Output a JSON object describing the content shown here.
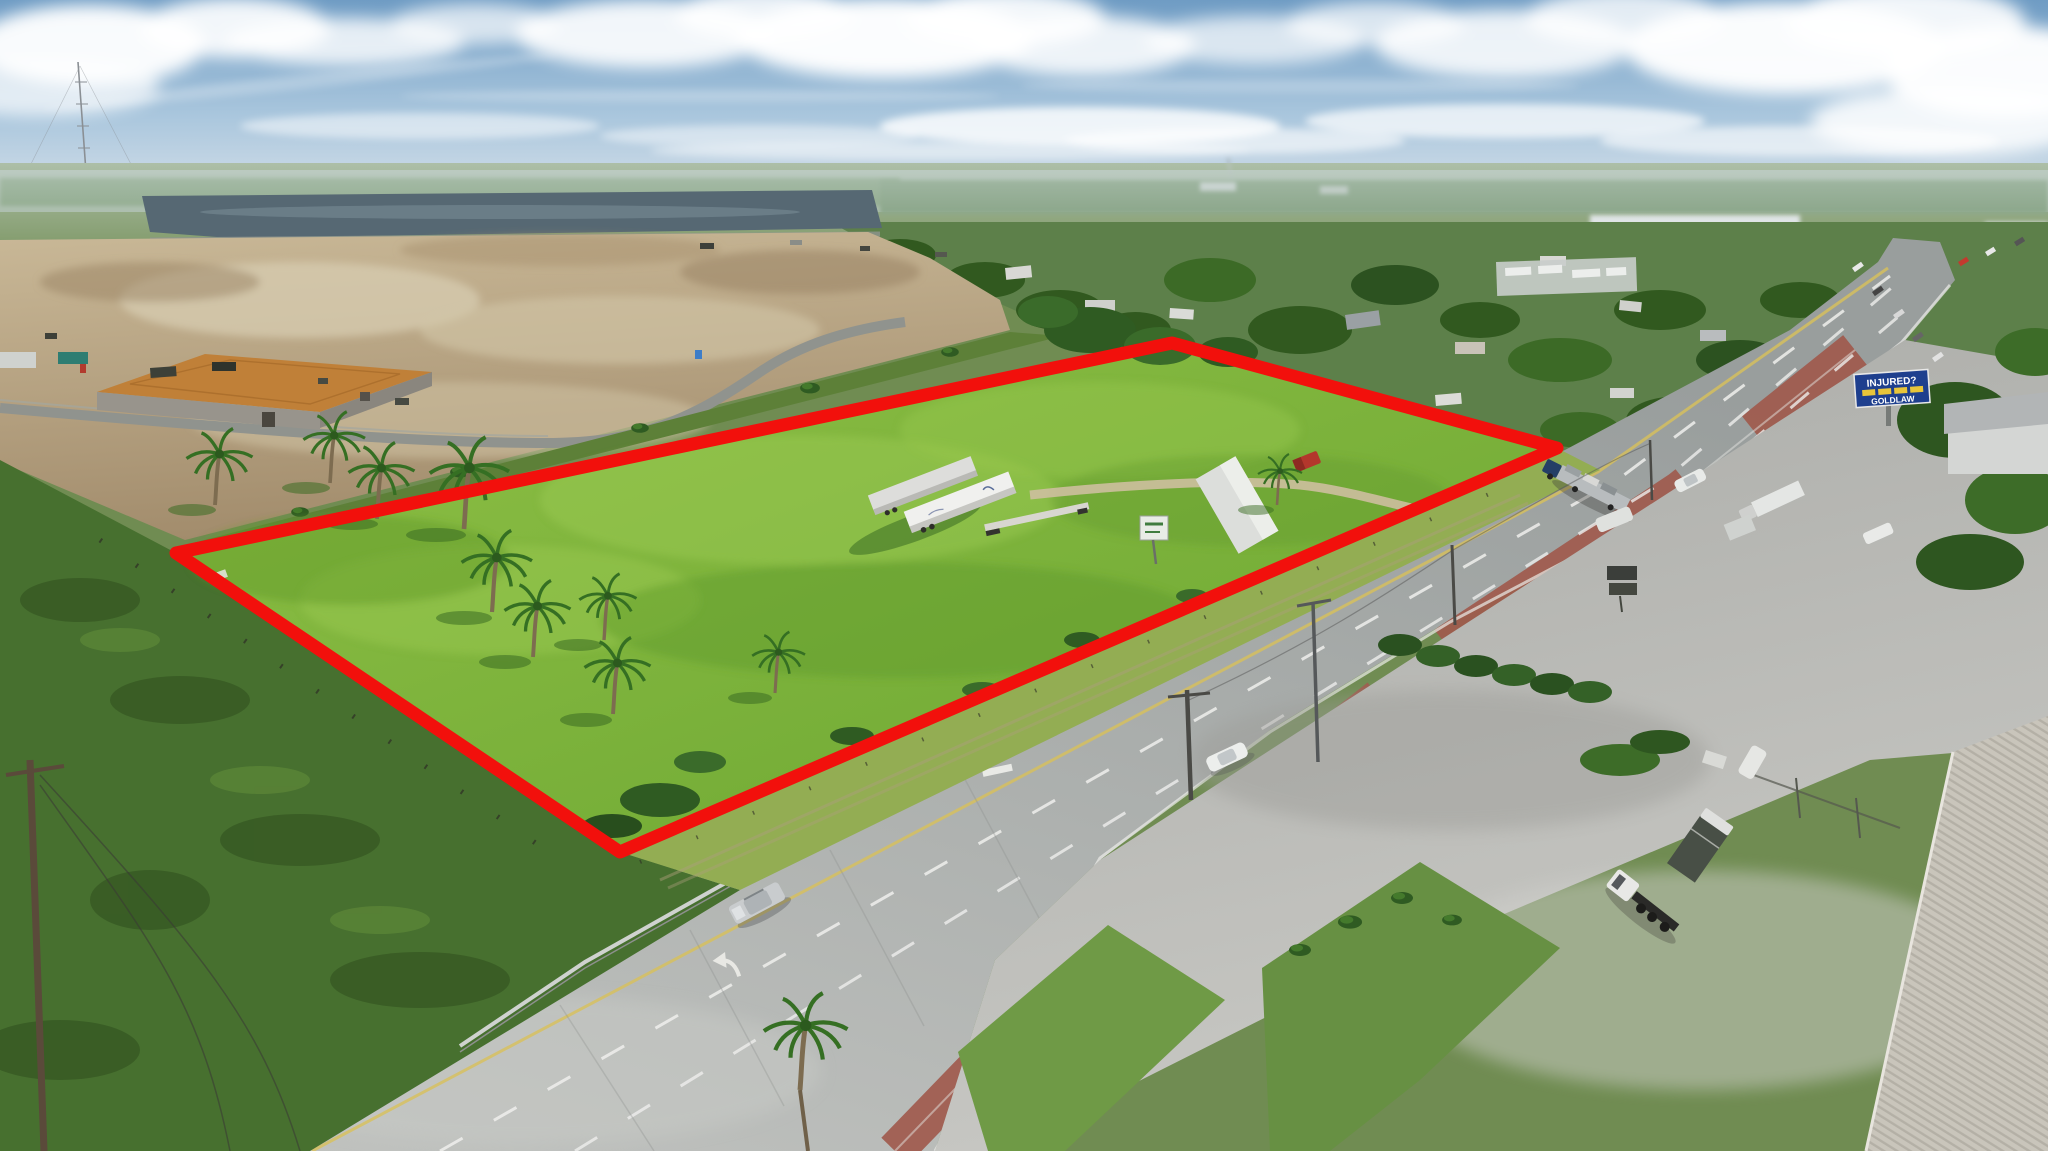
{
  "meta": {
    "type": "aerial-drone-photograph",
    "subject": "Vacant commercial land parcel outlined in red along a divided highway"
  },
  "palette": {
    "outline_red": "#f2100c",
    "sky_blue": "#7fa6c9",
    "parcel_green": "#7db43c",
    "dirt_tan": "#b7a489",
    "road_gray": "#b2b5b3",
    "median_brick": "#a05a4d",
    "pond_water": "#566873",
    "billboard_blue": "#1e3f8e",
    "billboard_text": "#ffffff"
  },
  "overlay": {
    "parcel_outline": {
      "color": "#f2100c",
      "stroke_width_px": 13,
      "vertices_px": [
        [
          176,
          553
        ],
        [
          1172,
          343
        ],
        [
          1557,
          448
        ],
        [
          620,
          852
        ]
      ]
    }
  },
  "billboard": {
    "line1": "INJURED?",
    "line2": "GOLDLAW"
  },
  "scene": {
    "sky": "blue sky with scattered cumulus clouds and thin cirrus",
    "upper_left": "retention pond and cleared dirt construction site with new subdivision roads and a house under construction",
    "center": "mowed green parcel containing two white semi trailers, a flatbed trailer, a gravel drive and cabbage palms",
    "right": "divided concrete highway with brick-red median, utility poles, parked trucks, truck yards and an attorney billboard",
    "bottom_right": "ribbed metal warehouse roof and truck chassis in a concrete yard",
    "vehicles": [
      "silver pickup with camper shell",
      "white sedan",
      "white car",
      "car-hauler semi",
      "white semi trailer",
      "box trucks",
      "bobtail truck chassis"
    ]
  }
}
